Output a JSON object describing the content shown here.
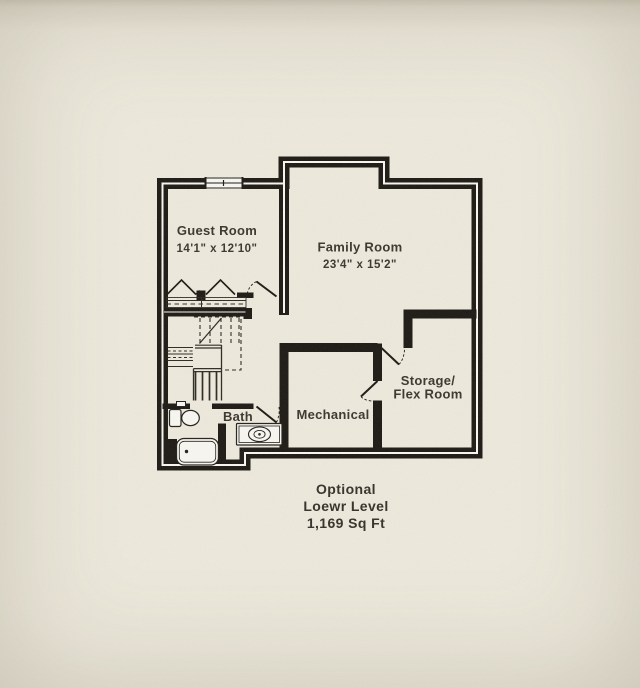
{
  "page": {
    "type": "floor-plan-drawing",
    "caption": {
      "line1": "Optional",
      "line2": "Loewr Level",
      "line3": "1,169 Sq Ft"
    }
  },
  "rooms": {
    "guest": {
      "name": "Guest Room",
      "dims": "14'1\" x 12'10\""
    },
    "family": {
      "name": "Family Room",
      "dims": "23'4\" x 15'2\""
    },
    "storage": {
      "name_line1": "Storage/",
      "name_line2": "Flex Room"
    },
    "mechanical": {
      "name": "Mechanical"
    },
    "bath": {
      "name": "Bath"
    }
  },
  "colors": {
    "paper": "#eeeadd",
    "paper_edge": "#d8d2c1",
    "wall_black": "#1c1914",
    "line_dark": "#2d2a24",
    "fixture_fill": "#f9f8f2",
    "text": "#3a362f"
  }
}
